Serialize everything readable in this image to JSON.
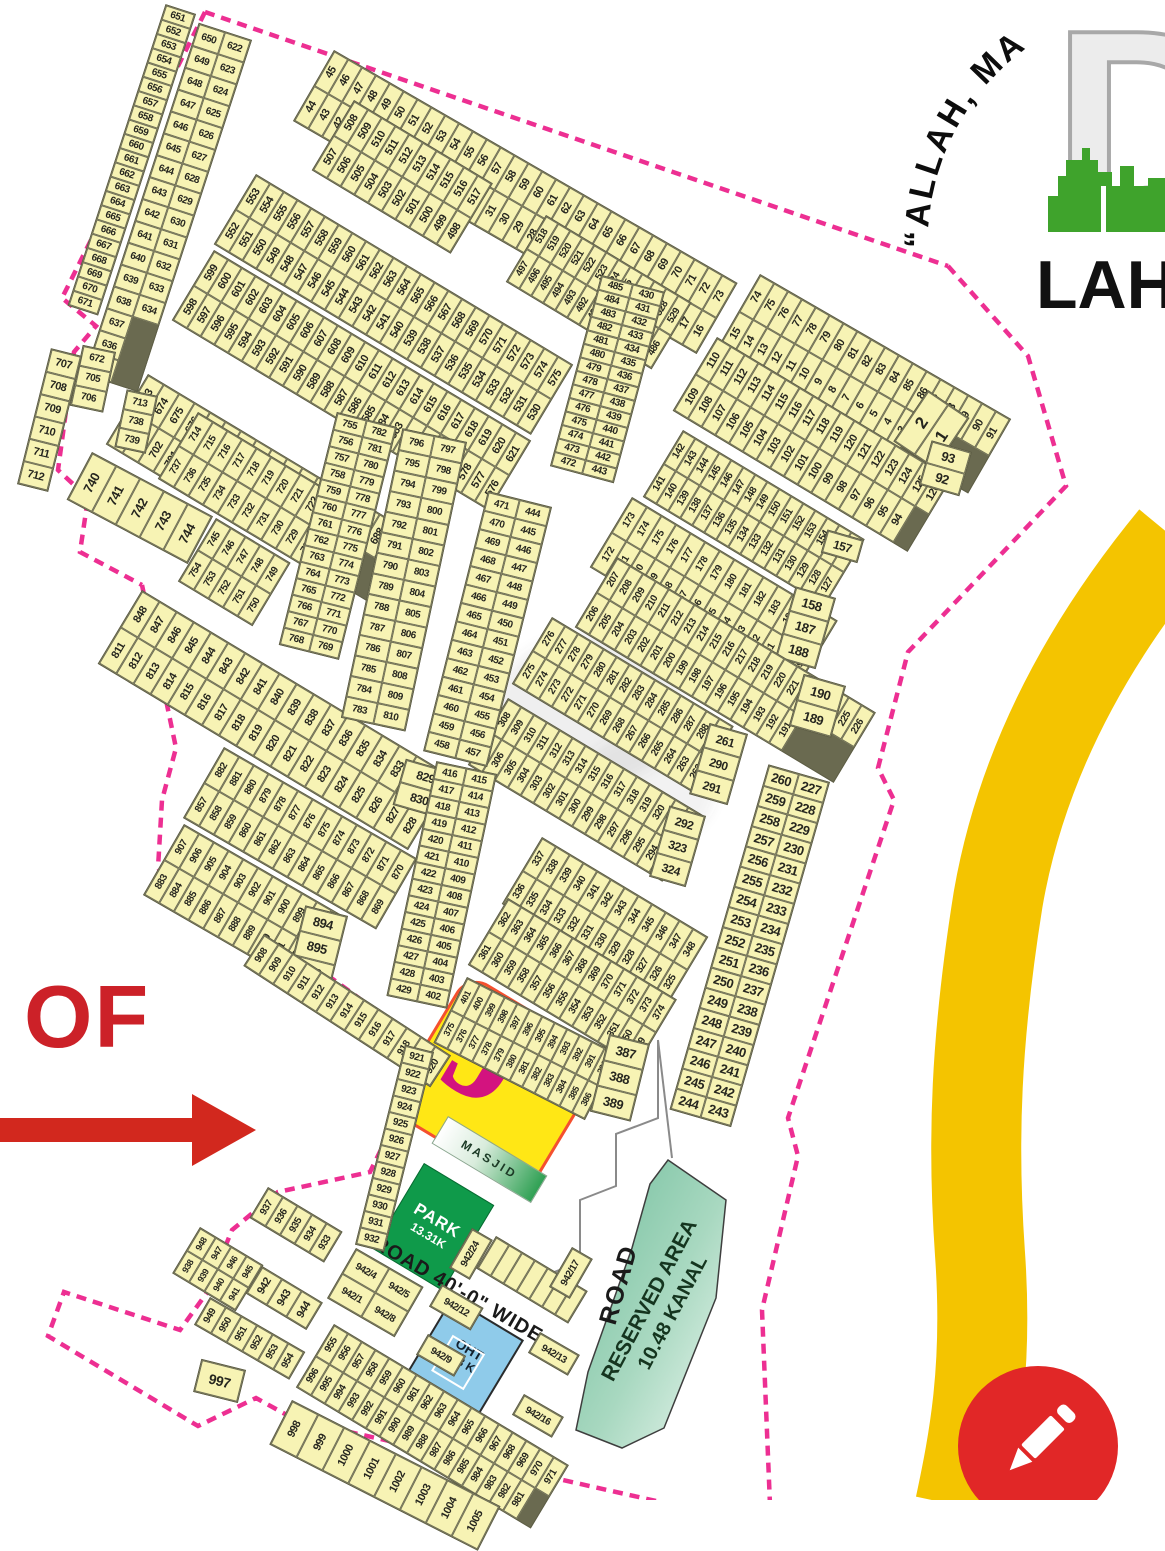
{
  "logo": {
    "letters": "DH",
    "name": "LAH",
    "motto": "“ALLAH, MA"
  },
  "annotations": {
    "of_label": "OF",
    "block_letter": "J"
  },
  "features": {
    "masjid": "MASJID",
    "park": "PARK",
    "park_area": "13.31K",
    "road": "ROAD",
    "road40": "ROAD 40'-0\" WIDE",
    "reserved_line1": "RESERVED AREA",
    "reserved_line2": "10.48 KANAL",
    "oht_line1": "OHT",
    "oht_line2": "2/3 K"
  },
  "colors": {
    "boundary": "#ED2F92",
    "road_yellow": "#F4C400",
    "park_green": "#0F9A4A",
    "oht_blue": "#8FCBEA",
    "block_yellow": "#FFE715",
    "block_border": "#F4502F",
    "block_letter": "#D3137F",
    "accent_red": "#CC2128",
    "plot_fill": "#F7F3B4",
    "logo_green": "#3FA32C"
  },
  "strips": {
    "s651": [
      "651",
      "652",
      "653",
      "654",
      "655",
      "656",
      "657",
      "658",
      "659",
      "660",
      "661",
      "662",
      "663",
      "664",
      "665",
      "666",
      "667",
      "668",
      "669",
      "670",
      "671"
    ],
    "s622top": [
      "650",
      "649",
      "648",
      "647",
      "646",
      "645",
      "644",
      "643",
      "642",
      "641",
      "640",
      "639",
      "638",
      "637",
      "636",
      "635"
    ],
    "s622bot": [
      "622",
      "623",
      "624",
      "625",
      "626",
      "627",
      "628",
      "629",
      "630",
      "631",
      "632",
      "633",
      "634"
    ],
    "s45top": [
      "45",
      "46",
      "47",
      "48",
      "49",
      "50",
      "51",
      "52",
      "53",
      "54",
      "55",
      "56",
      "57",
      "58",
      "59",
      "60",
      "61",
      "62",
      "63",
      "64",
      "65",
      "66",
      "67",
      "68",
      "69",
      "70",
      "71",
      "72",
      "73"
    ],
    "s45bot": [
      "44",
      "43",
      "42",
      "41",
      "40",
      "39",
      "38",
      "37",
      "36",
      "35",
      "34",
      "33",
      "32",
      "31",
      "30",
      "29",
      "28",
      "27",
      "26",
      "25",
      "24",
      "23",
      "22",
      "21",
      "20",
      "19",
      "18",
      "17",
      "16"
    ],
    "s74top": [
      "74",
      "75",
      "76",
      "77",
      "78",
      "79",
      "80",
      "81",
      "82",
      "83",
      "84",
      "85",
      "86",
      "87",
      "88",
      "89",
      "90",
      "91"
    ],
    "s74bot": [
      "15",
      "14",
      "13",
      "12",
      "11",
      "10",
      "9",
      "8",
      "7",
      "6",
      "5",
      "4",
      "3"
    ],
    "big12": [
      "2",
      "1"
    ],
    "s110top": [
      "110",
      "111",
      "112",
      "113",
      "114",
      "115",
      "116",
      "117",
      "118",
      "119",
      "120",
      "121",
      "122",
      "123",
      "124",
      "125",
      "126"
    ],
    "s110bot": [
      "109",
      "108",
      "107",
      "106",
      "105",
      "104",
      "103",
      "102",
      "101",
      "100",
      "99",
      "98",
      "97",
      "96",
      "95",
      "94"
    ],
    "s110end": [
      "93",
      "92"
    ],
    "s508atop": [
      "508",
      "509",
      "510",
      "511",
      "512",
      "513",
      "514",
      "515",
      "516",
      "517"
    ],
    "s508abot": [
      "507",
      "506",
      "505",
      "504",
      "503",
      "502",
      "501",
      "500",
      "499",
      "498"
    ],
    "s508btop": [
      "518",
      "519",
      "520",
      "521",
      "522",
      "523",
      "524",
      "525",
      "526",
      "527",
      "528",
      "529"
    ],
    "s508bbot": [
      "497",
      "496",
      "495",
      "494",
      "493",
      "492",
      "491",
      "490",
      "489",
      "488",
      "487",
      "486"
    ],
    "s553top": [
      "553",
      "554",
      "555",
      "556",
      "557",
      "558",
      "559",
      "560",
      "561",
      "562",
      "563",
      "564",
      "565",
      "566",
      "567",
      "568",
      "569",
      "570",
      "571",
      "572",
      "573",
      "574",
      "575"
    ],
    "s553bot": [
      "552",
      "551",
      "550",
      "549",
      "548",
      "547",
      "546",
      "545",
      "544",
      "543",
      "542",
      "541",
      "540",
      "539",
      "538",
      "537",
      "536",
      "535",
      "534",
      "533",
      "532",
      "531",
      "530"
    ],
    "s599top": [
      "599",
      "600",
      "601",
      "602",
      "603",
      "604",
      "605",
      "606",
      "607",
      "608",
      "609",
      "610",
      "611",
      "612",
      "613",
      "614",
      "615",
      "616",
      "617",
      "618",
      "619",
      "620",
      "621"
    ],
    "s599bot": [
      "598",
      "597",
      "596",
      "595",
      "594",
      "593",
      "592",
      "591",
      "590",
      "589",
      "588",
      "587",
      "586",
      "585",
      "584",
      "583",
      "582",
      "581",
      "580",
      "579",
      "578",
      "577",
      "576"
    ],
    "s672pre": [
      "672",
      "705",
      "706"
    ],
    "s672top": [
      "673",
      "674",
      "675",
      "676",
      "677",
      "678",
      "679",
      "680",
      "681",
      "682",
      "683",
      "684",
      "685",
      "686",
      "687",
      "688",
      "689"
    ],
    "s672bot": [
      "704",
      "703",
      "702",
      "701",
      "700",
      "699",
      "698",
      "697",
      "696",
      "695",
      "694",
      "693",
      "692",
      "691",
      "690"
    ],
    "s707": [
      "707",
      "708",
      "709",
      "710",
      "711",
      "712"
    ],
    "s713pre": [
      "713",
      "738",
      "739"
    ],
    "s713top": [
      "714",
      "715",
      "716",
      "717",
      "718",
      "719",
      "720",
      "721",
      "722",
      "723",
      "724",
      "725"
    ],
    "s713bot": [
      "737",
      "736",
      "735",
      "734",
      "733",
      "732",
      "731",
      "730",
      "729",
      "728",
      "727",
      "726"
    ],
    "s740": [
      "740",
      "741",
      "742",
      "743",
      "744"
    ],
    "s745top": [
      "745",
      "746",
      "747",
      "748",
      "749"
    ],
    "s745bot": [
      "754",
      "753",
      "752",
      "751",
      "750"
    ],
    "s811top": [
      "848",
      "847",
      "846",
      "845",
      "844",
      "843",
      "842",
      "841",
      "840",
      "839",
      "838",
      "837",
      "836",
      "835",
      "834",
      "833",
      "832",
      "831"
    ],
    "s811bot": [
      "811",
      "812",
      "813",
      "814",
      "815",
      "816",
      "817",
      "818",
      "819",
      "820",
      "821",
      "822",
      "823",
      "824",
      "825",
      "826",
      "827",
      "828"
    ],
    "s811end": [
      "829",
      "830"
    ],
    "s857top": [
      "882",
      "881",
      "880",
      "879",
      "878",
      "877",
      "876",
      "875",
      "874",
      "873",
      "872",
      "871",
      "870"
    ],
    "s857bot": [
      "857",
      "858",
      "859",
      "860",
      "861",
      "862",
      "863",
      "864",
      "865",
      "866",
      "867",
      "868",
      "869"
    ],
    "s883top": [
      "907",
      "906",
      "905",
      "904",
      "903",
      "902",
      "901",
      "900",
      "899",
      "898",
      "897"
    ],
    "s883bot": [
      "883",
      "884",
      "885",
      "886",
      "887",
      "888",
      "889",
      "890",
      "891",
      "892",
      "893"
    ],
    "s883end": [
      "894",
      "895",
      "896"
    ],
    "s908": [
      "908",
      "909",
      "910",
      "911",
      "912",
      "913",
      "914",
      "915",
      "916",
      "917",
      "918",
      "919",
      "920"
    ],
    "s921": [
      "921",
      "922",
      "923",
      "924",
      "925",
      "926",
      "927",
      "928",
      "929",
      "930",
      "931",
      "932"
    ],
    "s933": [
      "937",
      "936",
      "935",
      "934",
      "933"
    ],
    "s938top": [
      "948",
      "947",
      "946",
      "945"
    ],
    "s938bot": [
      "938",
      "939",
      "940",
      "941"
    ],
    "s938end": [
      "942",
      "943",
      "944"
    ],
    "s949": [
      "949",
      "950",
      "951",
      "952",
      "953",
      "954"
    ],
    "p997": [
      "997"
    ],
    "s956top": [
      "955",
      "956",
      "957",
      "958",
      "959",
      "960",
      "961",
      "962",
      "963",
      "964",
      "965",
      "966",
      "967",
      "968",
      "969",
      "970",
      "971"
    ],
    "s956bot": [
      "996",
      "995",
      "994",
      "993",
      "992",
      "991",
      "990",
      "989",
      "988",
      "987",
      "986",
      "985",
      "984",
      "983",
      "982",
      "981"
    ],
    "s998": [
      "998",
      "999",
      "1000",
      "1001",
      "1002",
      "1003",
      "1004",
      "1005"
    ],
    "s127top": [
      "142",
      "143",
      "144",
      "145",
      "146",
      "147",
      "148",
      "149",
      "150",
      "151",
      "152",
      "153",
      "154",
      "155",
      "156"
    ],
    "s127bot": [
      "141",
      "140",
      "139",
      "138",
      "137",
      "136",
      "135",
      "134",
      "133",
      "132",
      "131",
      "130",
      "129",
      "128",
      "127"
    ],
    "s127end": [
      "157"
    ],
    "s158top": [
      "173",
      "174",
      "175",
      "176",
      "177",
      "178",
      "179",
      "180",
      "181",
      "182",
      "183",
      "184",
      "185",
      "186"
    ],
    "s158bot": [
      "172",
      "171",
      "170",
      "169",
      "168",
      "167",
      "166",
      "165",
      "164",
      "163",
      "162",
      "161",
      "160",
      "159"
    ],
    "s158end": [
      "158",
      "187",
      "188"
    ],
    "s189top": [
      "207",
      "208",
      "209",
      "210",
      "211",
      "212",
      "213",
      "214",
      "215",
      "216",
      "217",
      "218",
      "219",
      "220",
      "221",
      "222",
      "223",
      "224",
      "225",
      "226"
    ],
    "s189bot": [
      "206",
      "205",
      "204",
      "203",
      "202",
      "201",
      "200",
      "199",
      "198",
      "197",
      "196",
      "195",
      "194",
      "193",
      "192",
      "191"
    ],
    "s189end": [
      "190",
      "189"
    ],
    "s276top": [
      "276",
      "277",
      "278",
      "279",
      "280",
      "281",
      "282",
      "283",
      "284",
      "285",
      "286",
      "287",
      "288",
      "289"
    ],
    "s276bot": [
      "275",
      "274",
      "273",
      "272",
      "271",
      "270",
      "269",
      "268",
      "267",
      "266",
      "265",
      "264",
      "263",
      "262"
    ],
    "s276end": [
      "261",
      "290",
      "291"
    ],
    "s303top": [
      "308",
      "309",
      "310",
      "311",
      "312",
      "313",
      "314",
      "315",
      "316",
      "317",
      "318",
      "319",
      "320",
      "321",
      "322"
    ],
    "s303bot": [
      "307",
      "306",
      "305",
      "304",
      "303",
      "302",
      "301",
      "300",
      "299",
      "298",
      "297",
      "296",
      "295",
      "294",
      "293"
    ],
    "s303end": [
      "292",
      "323",
      "324"
    ],
    "s325top": [
      "337",
      "338",
      "339",
      "340",
      "341",
      "342",
      "343",
      "344",
      "345",
      "346",
      "347",
      "348"
    ],
    "s325bot": [
      "336",
      "335",
      "334",
      "333",
      "332",
      "331",
      "330",
      "329",
      "328",
      "327",
      "326",
      "325"
    ],
    "s349top": [
      "362",
      "363",
      "364",
      "365",
      "366",
      "367",
      "368",
      "369",
      "370",
      "371",
      "372",
      "373",
      "374"
    ],
    "s349bot": [
      "361",
      "360",
      "359",
      "358",
      "357",
      "356",
      "355",
      "354",
      "353",
      "352",
      "351",
      "350",
      "349"
    ],
    "s375top": [
      "401",
      "400",
      "399",
      "398",
      "397",
      "396",
      "395",
      "394",
      "393",
      "392",
      "391",
      "390"
    ],
    "s375bot": [
      "375",
      "376",
      "377",
      "378",
      "379",
      "380",
      "381",
      "382",
      "383",
      "384",
      "385",
      "386"
    ],
    "s387": [
      "387",
      "388",
      "389"
    ],
    "c402L": [
      "416",
      "417",
      "418",
      "419",
      "420",
      "421",
      "422",
      "423",
      "424",
      "425",
      "426",
      "427",
      "428",
      "429"
    ],
    "c402R": [
      "415",
      "414",
      "413",
      "412",
      "411",
      "410",
      "409",
      "408",
      "407",
      "406",
      "405",
      "404",
      "403",
      "402"
    ],
    "c430L": [
      "485",
      "484",
      "483",
      "482",
      "481",
      "480",
      "479",
      "478",
      "477",
      "476",
      "475",
      "474",
      "473",
      "472"
    ],
    "c430R": [
      "430",
      "431",
      "432",
      "433",
      "434",
      "435",
      "436",
      "437",
      "438",
      "439",
      "440",
      "441",
      "442",
      "443"
    ],
    "c444L": [
      "471",
      "470",
      "469",
      "468",
      "467",
      "466",
      "465",
      "464",
      "463",
      "462",
      "461",
      "460",
      "459",
      "458"
    ],
    "c444R": [
      "444",
      "445",
      "446",
      "447",
      "448",
      "449",
      "450",
      "451",
      "452",
      "453",
      "454",
      "455",
      "456",
      "457"
    ],
    "c755L": [
      "755",
      "756",
      "757",
      "758",
      "759",
      "760",
      "761",
      "762",
      "763",
      "764",
      "765",
      "766",
      "767",
      "768"
    ],
    "c755R": [
      "782",
      "781",
      "780",
      "779",
      "778",
      "777",
      "776",
      "775",
      "774",
      "773",
      "772",
      "771",
      "770",
      "769"
    ],
    "c783L": [
      "796",
      "795",
      "794",
      "793",
      "792",
      "791",
      "790",
      "789",
      "788",
      "787",
      "786",
      "785",
      "784",
      "783"
    ],
    "c783R": [
      "797",
      "798",
      "799",
      "800",
      "801",
      "802",
      "803",
      "804",
      "805",
      "806",
      "807",
      "808",
      "809",
      "810"
    ],
    "c227L": [
      "260",
      "259",
      "258",
      "257",
      "256",
      "255",
      "254",
      "253",
      "252",
      "251",
      "250",
      "249",
      "248",
      "247",
      "246",
      "245",
      "244"
    ],
    "c227R": [
      "227",
      "228",
      "229",
      "230",
      "231",
      "232",
      "233",
      "234",
      "235",
      "236",
      "237",
      "238",
      "239",
      "240",
      "241",
      "242",
      "243"
    ],
    "blank7": [
      "",
      "",
      "",
      "",
      "",
      "",
      ""
    ],
    "g942a": [
      "942/4",
      "942/5"
    ],
    "g942b": [
      "942/1",
      "942/8"
    ],
    "g942c": [
      "942/12"
    ],
    "g942d": [
      "942/9"
    ],
    "g942e": [
      "942/13"
    ],
    "g942f": [
      "942/16"
    ],
    "g942g": [
      "942/17"
    ],
    "g942h": [
      "942/24"
    ]
  }
}
